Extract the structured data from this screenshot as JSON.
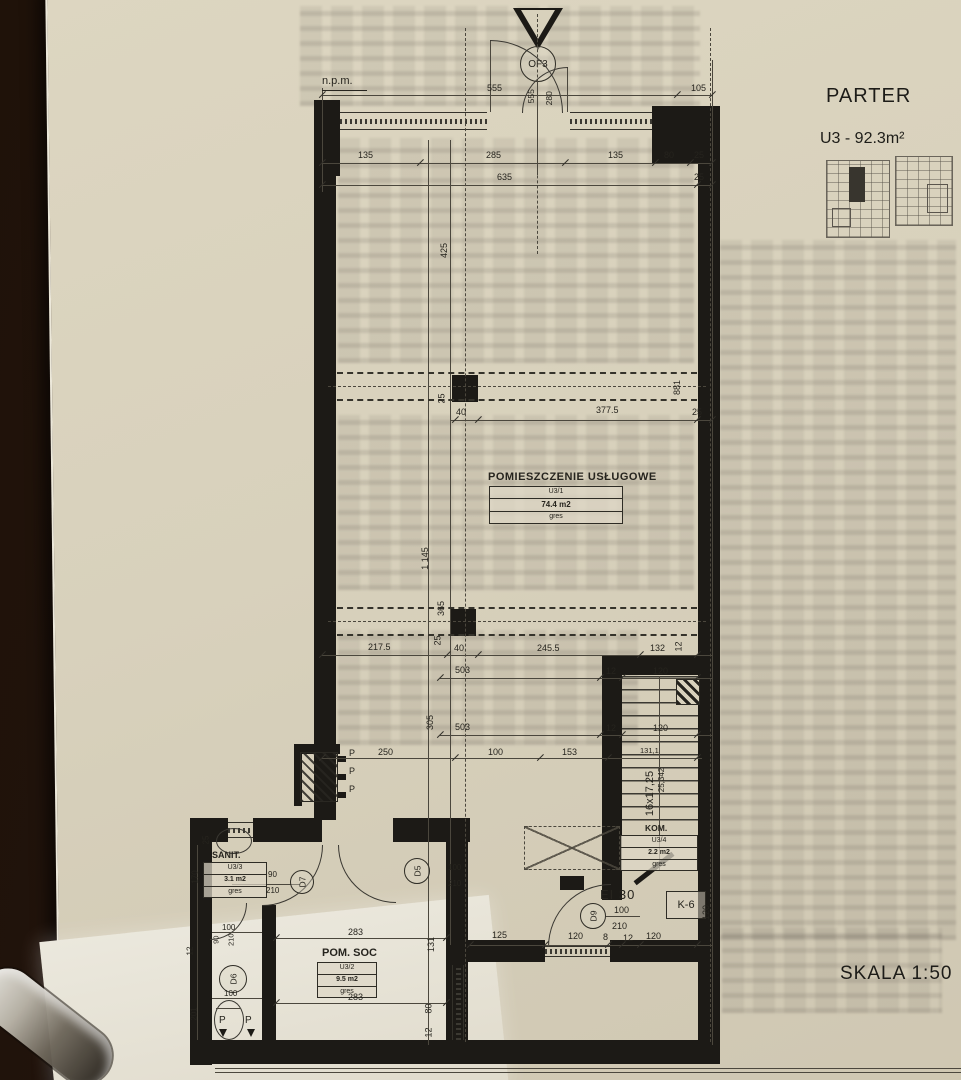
{
  "header": {
    "title": "PARTER",
    "unit": "U3 - 92.3m²",
    "scale": "SKALA 1:50",
    "datum": "n.p.m."
  },
  "entrance": {
    "symbol": "OF3"
  },
  "rooms": {
    "main": {
      "name": "POMIESZCZENIE USŁUGOWE",
      "id": "U3/1",
      "area": "74.4 m2",
      "floor": "gres"
    },
    "soc": {
      "name": "POM. SOC",
      "id": "U3/2",
      "area": "9.5 m2",
      "floor": "gres"
    },
    "sanit": {
      "name": "SANIT.",
      "id": "U3/3",
      "area": "3.1 m2",
      "floor": "gres"
    },
    "kom": {
      "name": "KOM.",
      "id": "U3/4",
      "area": "2.2 m2",
      "floor": "gres"
    }
  },
  "doors": {
    "d5": "D5",
    "d6": "D6",
    "d7": "D7",
    "d9": "D9"
  },
  "labels": {
    "fire": "EI 30",
    "duct": "K-6",
    "stair_steps": "16x17,25",
    "stair_run": "25,342",
    "riser": "P"
  },
  "dims": {
    "top": [
      "555",
      "105"
    ],
    "entry": [
      "555",
      "280"
    ],
    "row135": [
      "135",
      "285",
      "135",
      "80",
      "25"
    ],
    "row635": [
      "635",
      "25"
    ],
    "left": [
      "425",
      "25",
      "1 145",
      "365",
      "305"
    ],
    "beam_top": [
      "40",
      "377.5",
      "25",
      "881"
    ],
    "beam_bot": [
      "217.5",
      "25",
      "40",
      "245.5",
      "132",
      "12"
    ],
    "row503a": [
      "503",
      "12",
      "120"
    ],
    "row503b": [
      "503",
      "12",
      "120"
    ],
    "row250": [
      "250",
      "100",
      "153",
      "131,1"
    ],
    "bottom": [
      "125",
      "120",
      "8",
      "12",
      "120"
    ],
    "soc": [
      "283",
      "283",
      "131",
      "80",
      "12"
    ],
    "sanit": [
      "25",
      "90",
      "210",
      "170",
      "100",
      "90",
      "210",
      "12",
      "100",
      "201"
    ],
    "d5": [
      "100",
      "210"
    ],
    "ei": [
      "100",
      "210"
    ],
    "k6": [
      "120"
    ]
  }
}
